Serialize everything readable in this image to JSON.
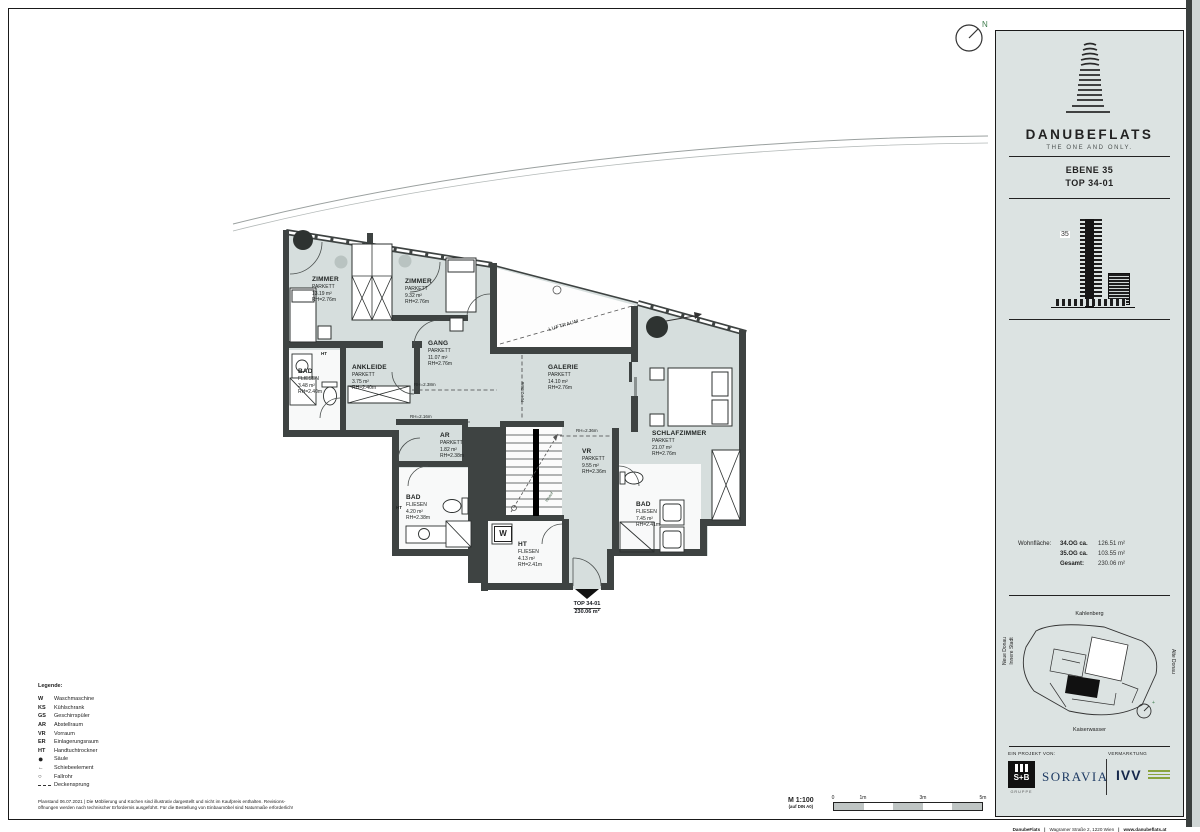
{
  "colors": {
    "room_fill": "#d6dedd",
    "wall": "#3e4342",
    "sidebar_bg": "#dce3e2",
    "soravia_blue": "#1d3a63",
    "ivv_green": "#8aa43c"
  },
  "brand": {
    "name": "DANUBEFLATS",
    "tagline": "THE ONE AND ONLY.",
    "level_label": "EBENE 35",
    "top_label": "TOP  34-01",
    "floor_badge": "35"
  },
  "areas": {
    "label": "Wohnfläche:",
    "rows": [
      {
        "name": "34.OG ca.",
        "value": "126.51 m²"
      },
      {
        "name": "35.OG ca.",
        "value": "103.55 m²"
      },
      {
        "name": "Gesamt:",
        "value": "230.06 m²"
      }
    ]
  },
  "map": {
    "north": "Kahlenberg",
    "west_line1": "Neue Donau",
    "west_line2": "Innere Stadt",
    "east": "Alte Donau",
    "south": "Kaiserwasser"
  },
  "partners": {
    "project_label": "EIN PROJEKT VON:",
    "marketing_label": "VERMARKTUNG",
    "sb_name": "S+B",
    "sb_sub": "GRUPPE",
    "soravia": "SORAVIA",
    "ivv": "IVV",
    "footer_brand": "DanubeFlats",
    "footer_address": "Wagramer Straße 2, 1220 Wien",
    "footer_web": "www.danubeflats.at"
  },
  "plan": {
    "rooms": [
      {
        "name": "ZIMMER",
        "floor": "PARKETT",
        "area": "13.19 m²",
        "rh": "RH=2.76m"
      },
      {
        "name": "ZIMMER",
        "floor": "PARKETT",
        "area": "9.32 m²",
        "rh": "RH=2.76m"
      },
      {
        "name": "GANG",
        "floor": "PARKETT",
        "area": "11.07 m²",
        "rh": "RH=2.76m"
      },
      {
        "name": "ANKLEIDE",
        "floor": "PARKETT",
        "area": "3.75 m²",
        "rh": "RH=2.40m"
      },
      {
        "name": "BAD",
        "floor": "FLIESEN",
        "area": "3.48 m²",
        "rh": "RH=2.40m"
      },
      {
        "name": "GALERIE",
        "floor": "PARKETT",
        "area": "14.10 m²",
        "rh": "RH=2.76m"
      },
      {
        "name": "AR",
        "floor": "PARKETT",
        "area": "1.82 m²",
        "rh": "RH=2.38m"
      },
      {
        "name": "VR",
        "floor": "PARKETT",
        "area": "9.55 m²",
        "rh": "RH=2.36m"
      },
      {
        "name": "SCHLAFZIMMER",
        "floor": "PARKETT",
        "area": "21.07 m²",
        "rh": "RH=2.76m"
      },
      {
        "name": "BAD",
        "floor": "FLIESEN",
        "area": "4.20 m²",
        "rh": "RH=2.38m"
      },
      {
        "name": "HT",
        "floor": "FLIESEN",
        "area": "4.13 m²",
        "rh": "RH=2.41m"
      },
      {
        "name": "BAD",
        "floor": "FLIESEN",
        "area": "7.45 m²",
        "rh": "RH=2.41m"
      }
    ],
    "luftraum": "LUFTRAUM",
    "hinauf": "hinauf",
    "w_marker": "W",
    "ht_marker_1": "HT",
    "ht_marker_2": "HT",
    "rh_label_1": "RH=2.38m",
    "rh_label_2": "RH=2.16m",
    "rh_label_3": "RH=2.36m",
    "rh_label_4": "RH 2.36m",
    "entry_top": "TOP 34-01",
    "entry_area": "230.06 m²"
  },
  "legend": {
    "title": "Legende:",
    "items": [
      {
        "abbr": "W",
        "label": "Waschmaschine"
      },
      {
        "abbr": "KS",
        "label": "Kühlschrank"
      },
      {
        "abbr": "GS",
        "label": "Geschirrspüler"
      },
      {
        "abbr": "AR",
        "label": "Abstellraum"
      },
      {
        "abbr": "VR",
        "label": "Vorraum"
      },
      {
        "abbr": "ER",
        "label": "Einlagerungsraum"
      },
      {
        "abbr": "HT",
        "label": "Handtuchtrockner"
      },
      {
        "abbr": "●",
        "label": "Säule"
      },
      {
        "abbr": "←",
        "label": "Schiebeelement"
      },
      {
        "abbr": "○",
        "label": "Fallrohr"
      },
      {
        "abbr": "",
        "label": "Deckensprung"
      }
    ]
  },
  "footer": {
    "line1": "Planstand 06.07.2021 | Die Möblierung und Küchen sind illustrativ dargestellt und nicht im Kaufpreis enthalten. Revisions-",
    "line2": "öffnungen werden nach technischer Erfordernis ausgeführt. Für die Bestellung von Einbaumöbel sind Naturmaße erforderlich!",
    "scale": "M 1:100",
    "scale_sub": "(auf DIN A0)",
    "tick0": "0",
    "tick1": "1m",
    "tick3": "3m",
    "tick5": "5m"
  },
  "compass": {
    "n": "N"
  }
}
